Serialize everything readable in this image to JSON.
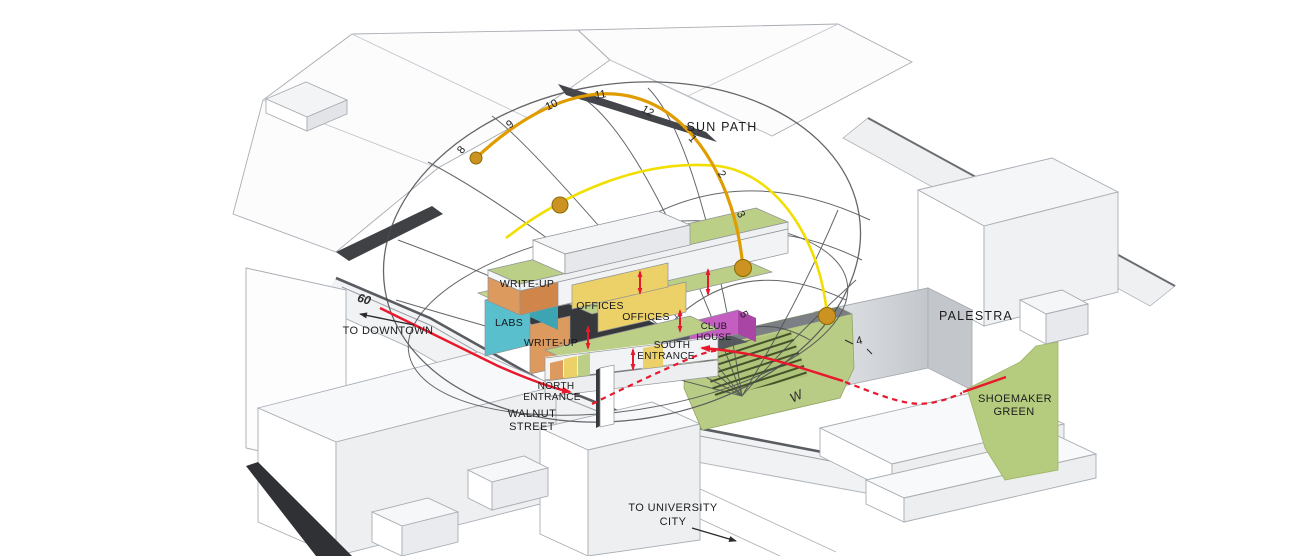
{
  "diagram": {
    "type": "site-massing-sun-path-diagram"
  },
  "sun_path": {
    "label": "SUN PATH",
    "hours": [
      "8",
      "9",
      "10",
      "11",
      "12",
      "1",
      "2",
      "3",
      "5"
    ],
    "hour_extra": "4"
  },
  "program_labels": {
    "writeup_upper": "WRITE-UP",
    "offices_upper": "OFFICES",
    "offices_mid": "OFFICES",
    "labs": "LABS",
    "writeup_lower": "WRITE-UP",
    "clubhouse_line1": "CLUB",
    "clubhouse_line2": "HOUSE"
  },
  "entrances": {
    "north_line1": "NORTH",
    "north_line2": "ENTRANCE",
    "south_line1": "SOUTH",
    "south_line2": "ENTRANCE"
  },
  "context": {
    "palestra": "PALESTRA",
    "shoemaker_line1": "SHOEMAKER",
    "shoemaker_line2": "GREEN",
    "walnut_line1": "WALNUT",
    "walnut_line2": "STREET",
    "to_downtown": "TO DOWNTOWN",
    "to_university_line1": "TO UNIVERSITY",
    "to_university_line2": "CITY",
    "street_width": "60",
    "compass_west": "W"
  },
  "colors": {
    "green_roof": "#BCCF86",
    "site_green": "#B5CB7D",
    "offices_yellow": "#ECD068",
    "labs_teal": "#59BFCC",
    "writeup_orange": "#DD9A5E",
    "clubhouse_purple": "#C45EC0",
    "sun_arc_primary": "#E09C00",
    "sun_arc_secondary": "#F2DE00",
    "sun_dot": "#CC9322",
    "circulation_red": "#E8192C",
    "wireframe": "#4A4C50"
  }
}
